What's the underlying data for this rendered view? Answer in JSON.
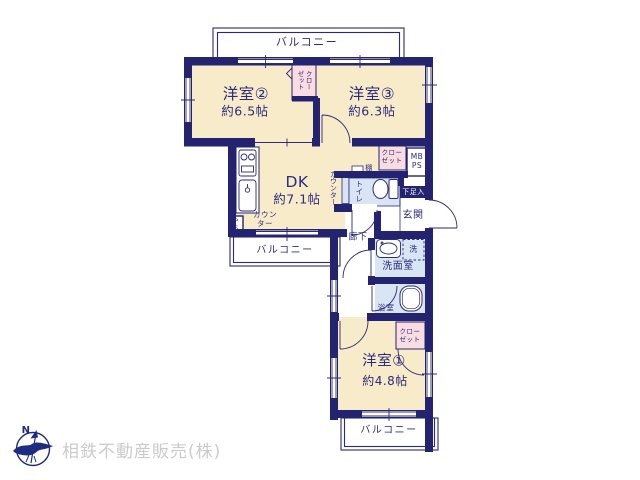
{
  "colors": {
    "wall_navy": "#232370",
    "line_navy": "#2b2b78",
    "text_navy": "#2b2b80",
    "room_cream": "#f8ebc9",
    "closet_pink": "#f9dde1",
    "water_blue": "#d9e5f2",
    "company_gray": "#cbcbcb",
    "logo_navy": "#1e2b80"
  },
  "plan": {
    "balcony_top": "バルコニー",
    "balcony_mid": "バルコニー",
    "balcony_bottom": "バルコニー",
    "rooms": {
      "room2": {
        "name": "洋室②",
        "size": "約6.5帖"
      },
      "room3": {
        "name": "洋室③",
        "size": "約6.3帖"
      },
      "room1": {
        "name": "洋室①",
        "size": "約4.8帖"
      },
      "dk": {
        "name": "DK",
        "size": "約7.1帖"
      },
      "genkan": "玄関",
      "rouka": "廊下",
      "senmenshitsu": "洗面室",
      "yokushitsu": "浴室",
      "toilet": "トイレ"
    },
    "fixtures": {
      "closet2": "クロー\nゼット",
      "closet_mid": "クロー\nゼット",
      "closet1": "クロー\nゼット",
      "mbps": "MB\nPS",
      "ps": "PS",
      "tana": "棚",
      "counter_dk": "カウン\nター",
      "counter_side": "カウンター",
      "getabako": "下足入",
      "washer": "洗"
    }
  },
  "footer": {
    "company": "相鉄不動産販売(株)",
    "compass_n": "N"
  }
}
